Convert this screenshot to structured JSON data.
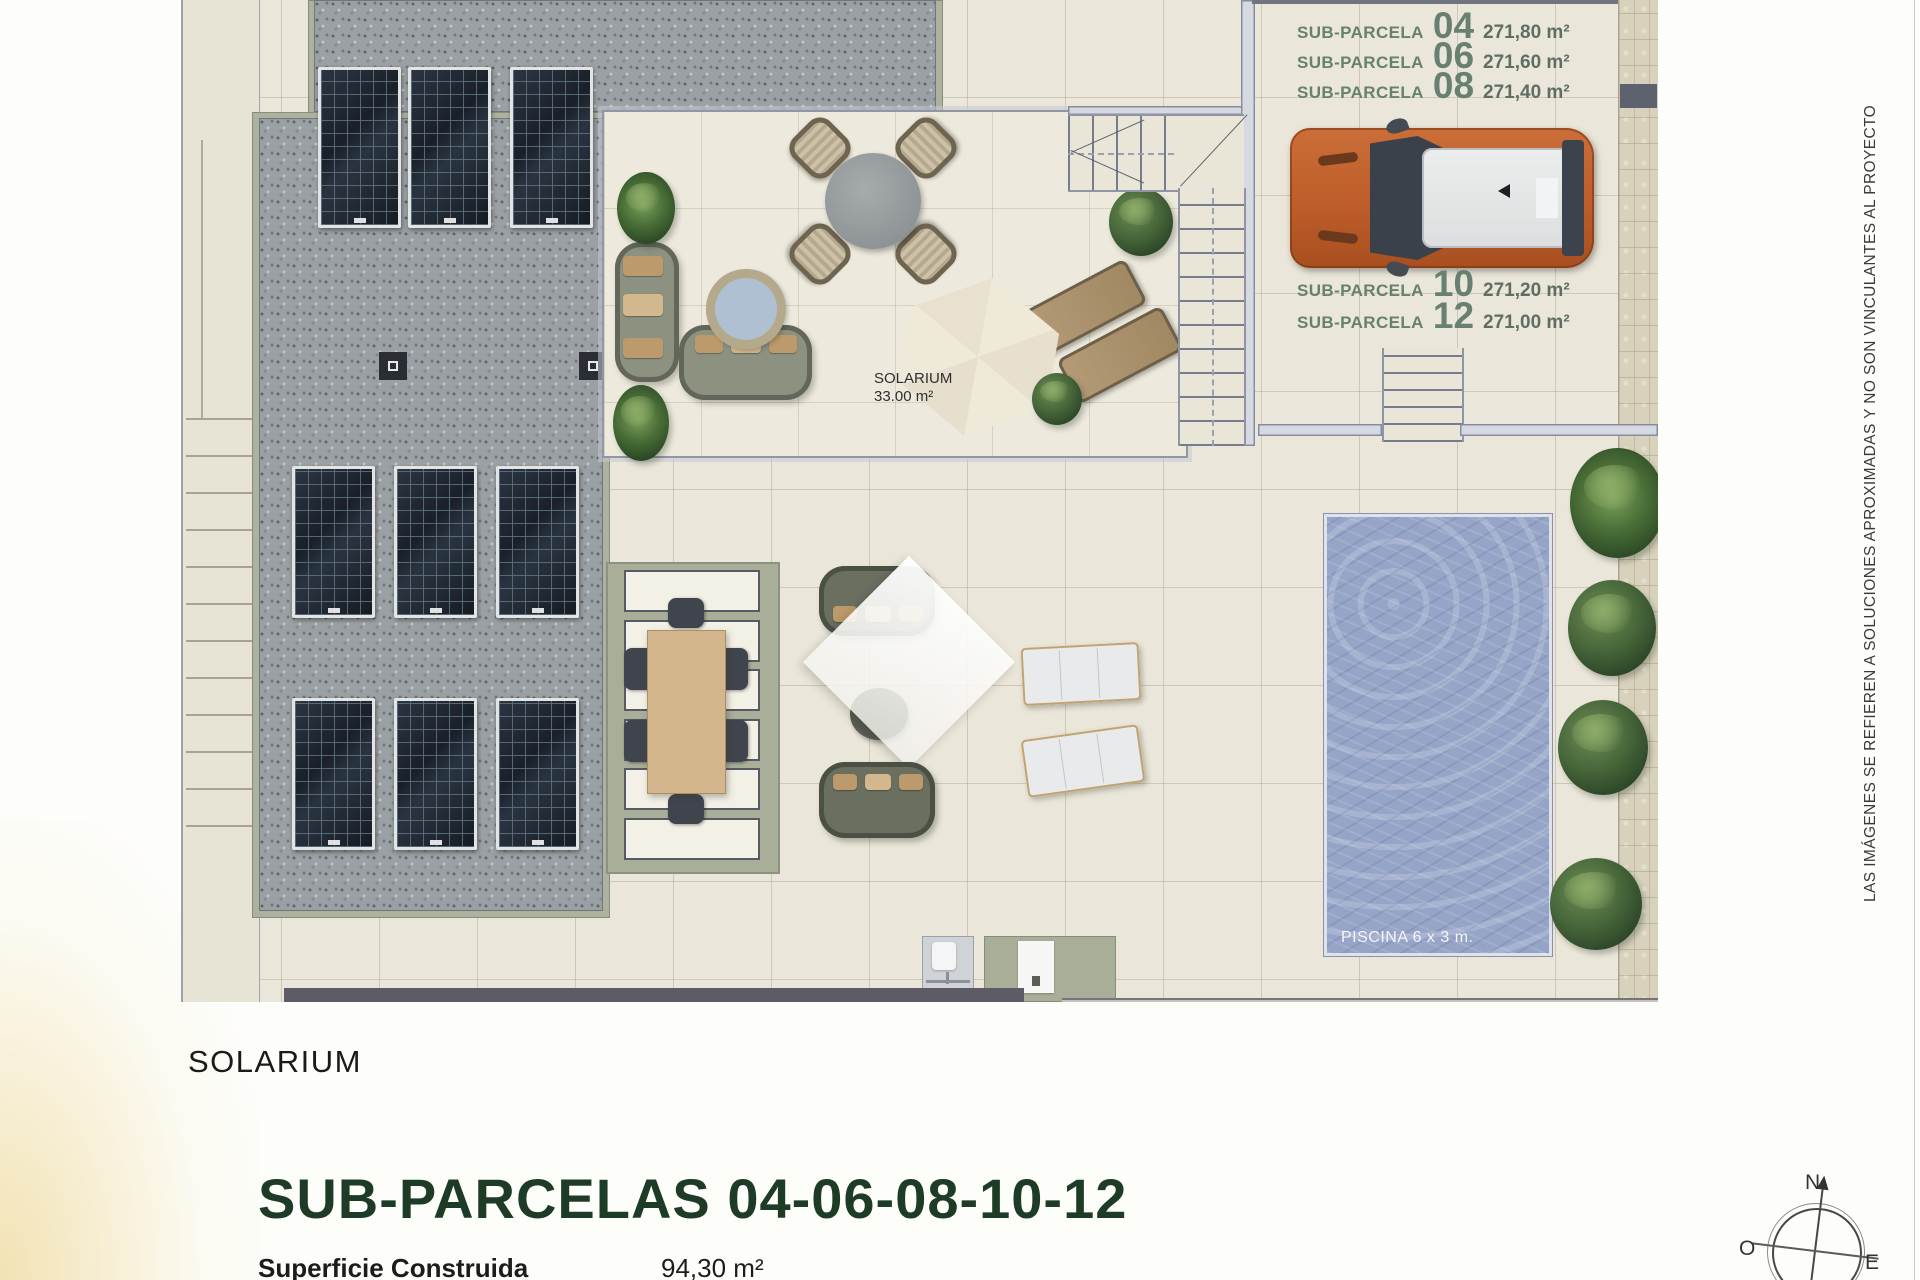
{
  "side_note": "LAS IMÁGENES SE REFIEREN A SOLUCIONES APROXIMADAS Y NO SON VINCULANTES AL PROYECTO",
  "solarium_inline": {
    "line1": "SOLARIUM",
    "line2": "33.00 m²"
  },
  "pool": {
    "label": "PISCINA 6 x 3 m."
  },
  "parcels_top": [
    {
      "label": "SUB-PARCELA",
      "number": "04",
      "area": "271,80 m²"
    },
    {
      "label": "SUB-PARCELA",
      "number": "06",
      "area": "271,60 m²"
    },
    {
      "label": "SUB-PARCELA",
      "number": "08",
      "area": "271,40 m²"
    }
  ],
  "parcels_mid": [
    {
      "label": "SUB-PARCELA",
      "number": "10",
      "area": "271,20 m²"
    },
    {
      "label": "SUB-PARCELA",
      "number": "12",
      "area": "271,00 m²"
    }
  ],
  "footer": {
    "floor_label": "SOLARIUM",
    "title": "SUB-PARCELAS 04-06-08-10-12",
    "surface_label": "Superficie Construida",
    "surface_value": "94,30 m²"
  },
  "compass": {
    "north": "N",
    "west": "O",
    "east": "E"
  },
  "colors": {
    "title_green": "#1d3b26",
    "parcel_text_green": "#68806f",
    "pool_water_blue": "#96a5c7",
    "car_orange": "#c4622e",
    "roof_gravel_gray": "#9aa0a3",
    "sage_band": "#adb29f"
  }
}
